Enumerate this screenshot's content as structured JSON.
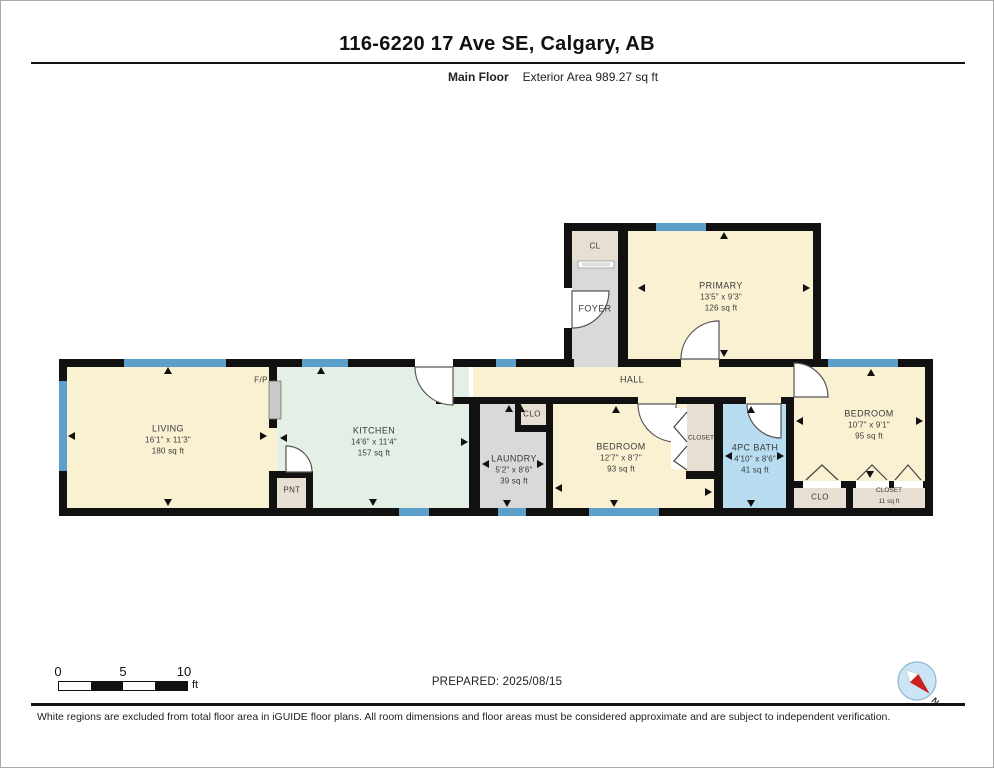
{
  "header": {
    "title": "116-6220 17 Ave SE, Calgary, AB",
    "floor_label": "Main Floor",
    "area_label": "Exterior Area 989.27 sq ft"
  },
  "rooms": {
    "cl": {
      "name": "CL"
    },
    "foyer": {
      "name": "FOYER"
    },
    "primary": {
      "name": "PRIMARY",
      "dims": "13'5\" x 9'3\"",
      "area": "126 sq ft"
    },
    "living": {
      "name": "LIVING",
      "dims": "16'1\" x 11'3\"",
      "area": "180 sq ft"
    },
    "fireplace": {
      "name": "F/P"
    },
    "kitchen": {
      "name": "KITCHEN",
      "dims": "14'6\" x 11'4\"",
      "area": "157 sq ft"
    },
    "pantry": {
      "name": "PNT"
    },
    "hall": {
      "name": "HALL"
    },
    "laundry": {
      "name": "LAUNDRY",
      "dims": "5'2\" x 8'6\"",
      "area": "39 sq ft"
    },
    "clo_hall": {
      "name": "CLO"
    },
    "bedroom_mid": {
      "name": "BEDROOM",
      "dims": "12'7\" x 8'7\"",
      "area": "93 sq ft"
    },
    "closet_mid": {
      "name": "CLOSET"
    },
    "bath": {
      "name": "4PC BATH",
      "dims": "4'10\" x 8'6\"",
      "area": "41 sq ft"
    },
    "bedroom_right": {
      "name": "BEDROOM",
      "dims": "10'7\" x 9'1\"",
      "area": "95 sq ft"
    },
    "clo_right": {
      "name": "CLO"
    },
    "closet_right": {
      "name": "CLOSET",
      "area": "11 sq ft"
    }
  },
  "scale_bar": {
    "ticks": [
      "0",
      "5",
      "10"
    ],
    "unit": "ft"
  },
  "compass": {
    "north_label": "N"
  },
  "footer": {
    "prepared": "PREPARED: 2025/08/15",
    "disclaimer": "White regions are excluded from total floor area in iGUIDE floor plans. All room dimensions and floor areas must be considered approximate and are subject to independent verification."
  },
  "colors": {
    "wall": "#111111",
    "room_cream": "#FAF0D2",
    "room_mint": "#E4EFE6",
    "room_gray": "#D9D9D9",
    "room_beige": "#E6DFD2",
    "room_blue": "#B8DDF1",
    "window": "#5C9FCB"
  }
}
